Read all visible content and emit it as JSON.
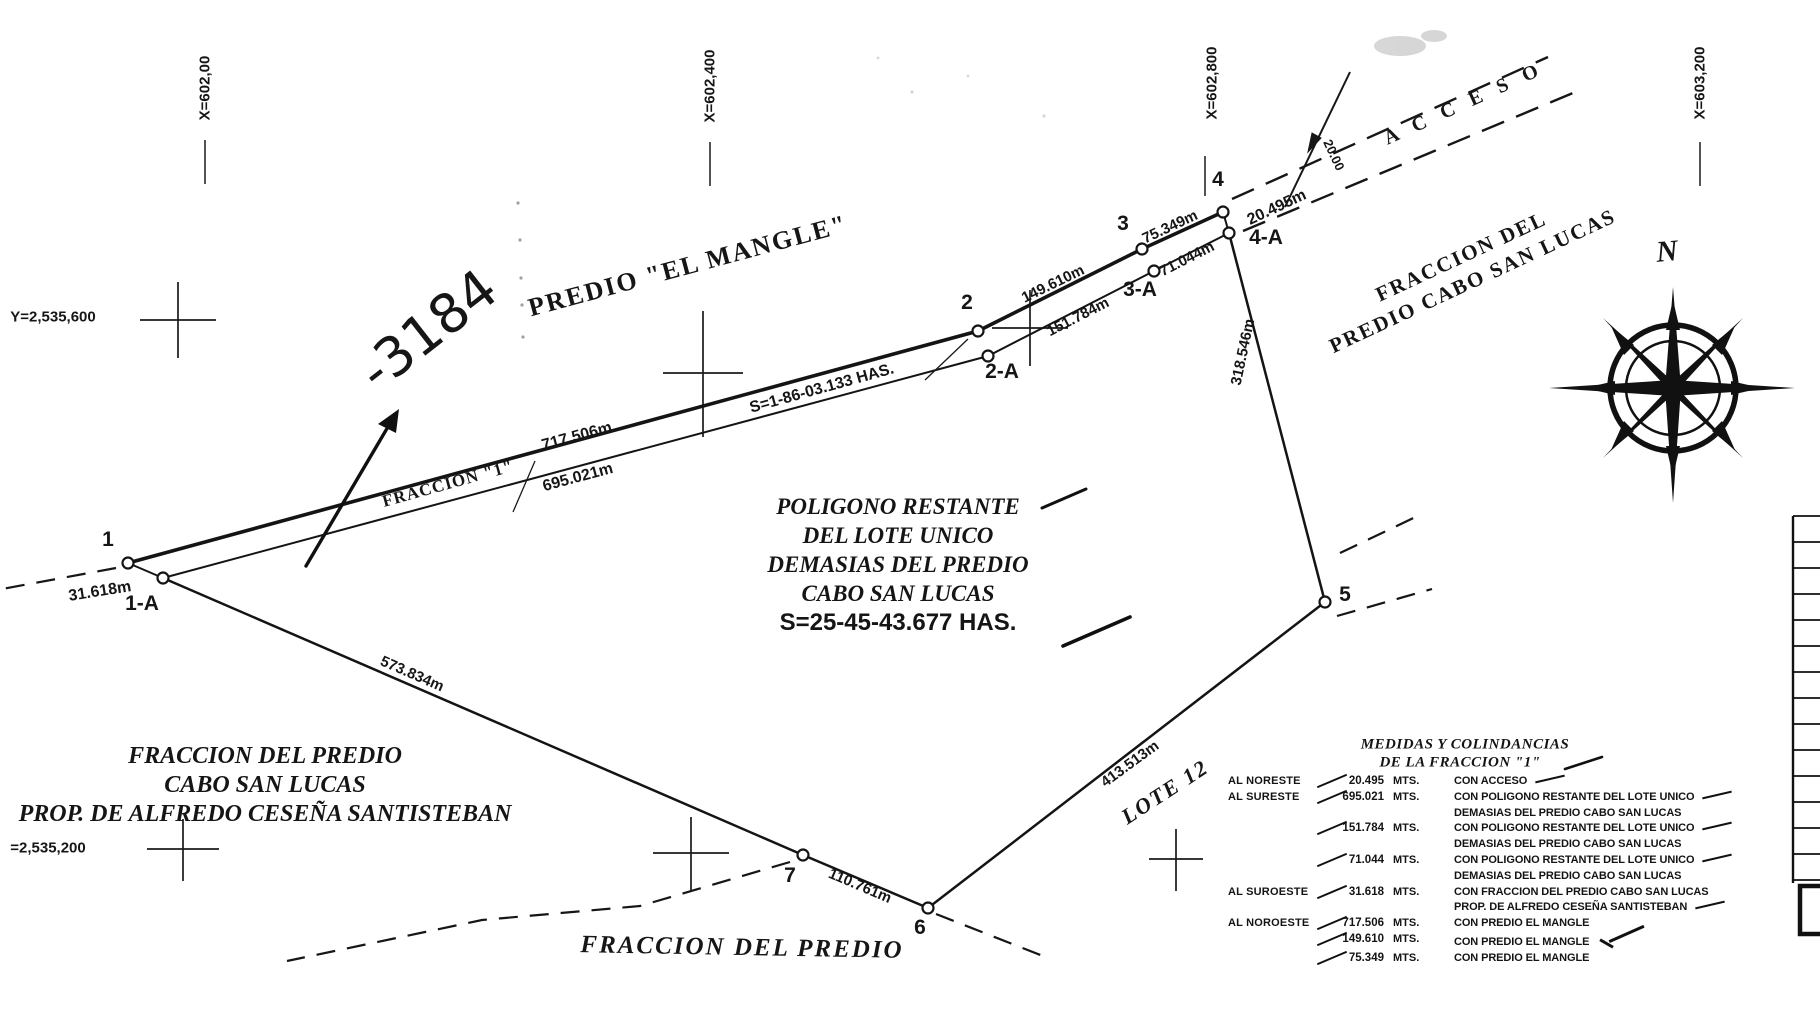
{
  "grid": {
    "x_labels": [
      "X=602,00",
      "X=602,400",
      "X=602,800",
      "X=603,200"
    ],
    "y_label_top": "Y=2,535,600",
    "y_label_bottom": "=2,535,200"
  },
  "handwriting": {
    "number": "-3184"
  },
  "compass": {
    "north": "N"
  },
  "region_labels": {
    "el_mangle": "PREDIO \"EL MANGLE\"",
    "right_line1": "FRACCION DEL",
    "right_line2": "PREDIO CABO SAN LUCAS",
    "left_line1": "FRACCION DEL PREDIO",
    "left_line2": "CABO SAN LUCAS",
    "left_line3": "PROP. DE ALFREDO CESEÑA SANTISTEBAN",
    "bottom": "FRACCION DEL PREDIO",
    "lote12": "LOTE 12",
    "acceso": "A C C E S O"
  },
  "center_block": {
    "line1": "POLIGONO RESTANTE",
    "line2": "DEL LOTE UNICO",
    "line3": "DEMASIAS DEL PREDIO",
    "line4": "CABO SAN LUCAS",
    "area": "S=25-45-43.677 HAS."
  },
  "fraccion1": {
    "name": "FRACCION \"1\"",
    "area": "S=1-86-03.133 HAS."
  },
  "edge_measurements": {
    "m717": "717.506m",
    "m695": "695.021m",
    "m149": "149.610m",
    "m151": "151.784m",
    "m75": "75.349m",
    "m71": "71.044m",
    "m20": "20.495m",
    "m318": "318.546m",
    "m413": "413.513m",
    "m573": "573.834m",
    "m110": "110.761m",
    "m31": "31.618m",
    "road_width": "20.00"
  },
  "vertex_labels": {
    "v1": "1",
    "v1a": "1-A",
    "v2": "2",
    "v2a": "2-A",
    "v3": "3",
    "v3a": "3-A",
    "v4": "4",
    "v4a": "4-A",
    "v5": "5",
    "v6": "6",
    "v7": "7"
  },
  "table": {
    "title1": "MEDIDAS Y COLINDANCIAS",
    "title2": "DE LA FRACCION \"1\"",
    "rows": [
      {
        "dir": "AL NORESTE",
        "value": "20.495",
        "unit": "MTS.",
        "desc": [
          "CON ACCESO"
        ]
      },
      {
        "dir": "AL SURESTE",
        "value": "695.021",
        "unit": "MTS.",
        "desc": [
          "CON POLIGONO RESTANTE DEL LOTE UNICO",
          "DEMASIAS DEL PREDIO CABO SAN LUCAS"
        ]
      },
      {
        "dir": "",
        "value": "151.784",
        "unit": "MTS.",
        "desc": [
          "CON POLIGONO RESTANTE DEL LOTE UNICO",
          "DEMASIAS DEL PREDIO CABO SAN LUCAS"
        ]
      },
      {
        "dir": "",
        "value": "71.044",
        "unit": "MTS.",
        "desc": [
          "CON POLIGONO RESTANTE DEL LOTE UNICO",
          "DEMASIAS DEL PREDIO CABO SAN LUCAS"
        ]
      },
      {
        "dir": "AL SUROESTE",
        "value": "31.618",
        "unit": "MTS.",
        "desc": [
          "CON FRACCION DEL PREDIO CABO SAN LUCAS",
          "PROP. DE ALFREDO CESEÑA SANTISTEBAN"
        ]
      },
      {
        "dir": "AL NOROESTE",
        "value": "717.506",
        "unit": "MTS.",
        "desc": [
          "CON PREDIO EL MANGLE"
        ]
      },
      {
        "dir": "",
        "value": "149.610",
        "unit": "MTS.",
        "desc": [
          "CON PREDIO EL MANGLE"
        ]
      },
      {
        "dir": "",
        "value": "75.349",
        "unit": "MTS.",
        "desc": [
          "CON PREDIO EL MANGLE"
        ]
      }
    ]
  }
}
